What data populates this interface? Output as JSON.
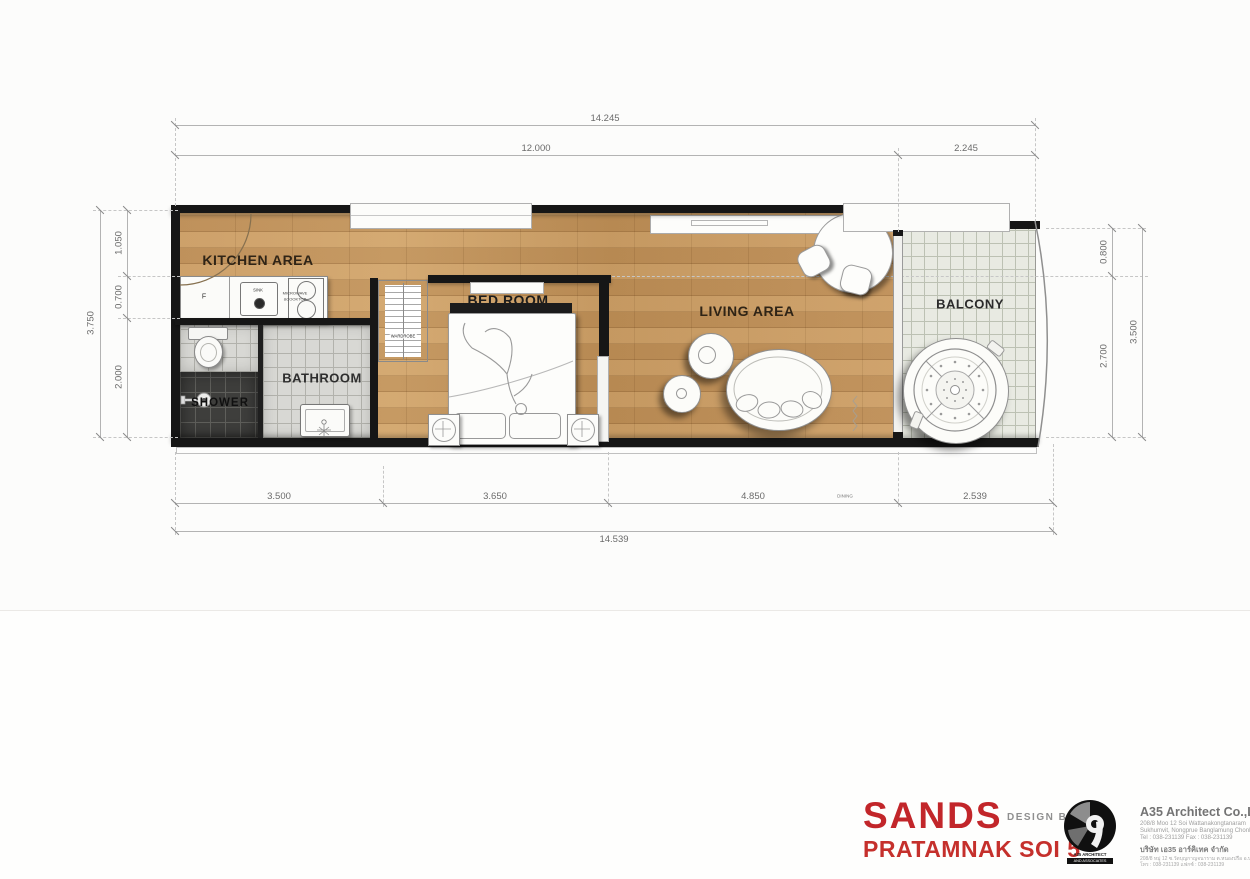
{
  "plan": {
    "labels": {
      "kitchen": "KITCHEN AREA",
      "bathroom": "BATHROOM",
      "shower": "SHOWER",
      "bedroom": "BED ROOM",
      "wardrobe": "WARDROBE",
      "living": "LIVING AREA",
      "balcony": "BALCONY"
    },
    "fixtures": {
      "fridge": "F",
      "sink": "SINK",
      "cooktop_line1": "MICROWAVE",
      "cooktop_line2": "&COOKTOP",
      "dining_note": "DINING"
    },
    "dimensions": {
      "top_total": "14.245",
      "top_segments": [
        "12.000",
        "2.245"
      ],
      "bottom_segments": [
        "3.500",
        "3.650",
        "4.850",
        "2.539"
      ],
      "bottom_total": "14.539",
      "left_total": "3.750",
      "left_segments": [
        "1.050",
        "0.700",
        "2.000"
      ],
      "right_segments": [
        "0.800",
        "2.700"
      ],
      "right_total": "3.500"
    }
  },
  "title_block": {
    "project_name": "SANDS",
    "project_location": "PRATAMNAK SOI 5",
    "design_by": "DESIGN BY",
    "logo_caption1": "A35 ARCHITECT",
    "logo_caption2": "AND ASSOCIATES",
    "company": {
      "name": "A35 Architect Co.,Ltd",
      "address1": "208/8 Moo 12 Soi Wattanakongtanaram",
      "address2": "Sukhumvit, Nongprue Banglamung Chonburi 20150",
      "phone": "Tel : 038-231139 Fax : 038-231139",
      "thai_name": "บริษัท เอ35 อาร์คิเทค จำกัด",
      "thai_address": "208/8 หมู่ 12 ซ.วัดบุญกาญจนาราม ต.หนองปรือ อ.บางละมุง จ.ชลบุรี 20150",
      "thai_phone": "โทร : 038-231139 แฟกซ์ : 038-231139"
    }
  },
  "colors": {
    "accent_red": "#c4282a",
    "wall_black": "#161616",
    "wood_floor": "#c89a63",
    "tile_light": "#d7d7d3",
    "tile_dark": "#3d3d3b",
    "balcony_tile": "#e8eae2"
  }
}
